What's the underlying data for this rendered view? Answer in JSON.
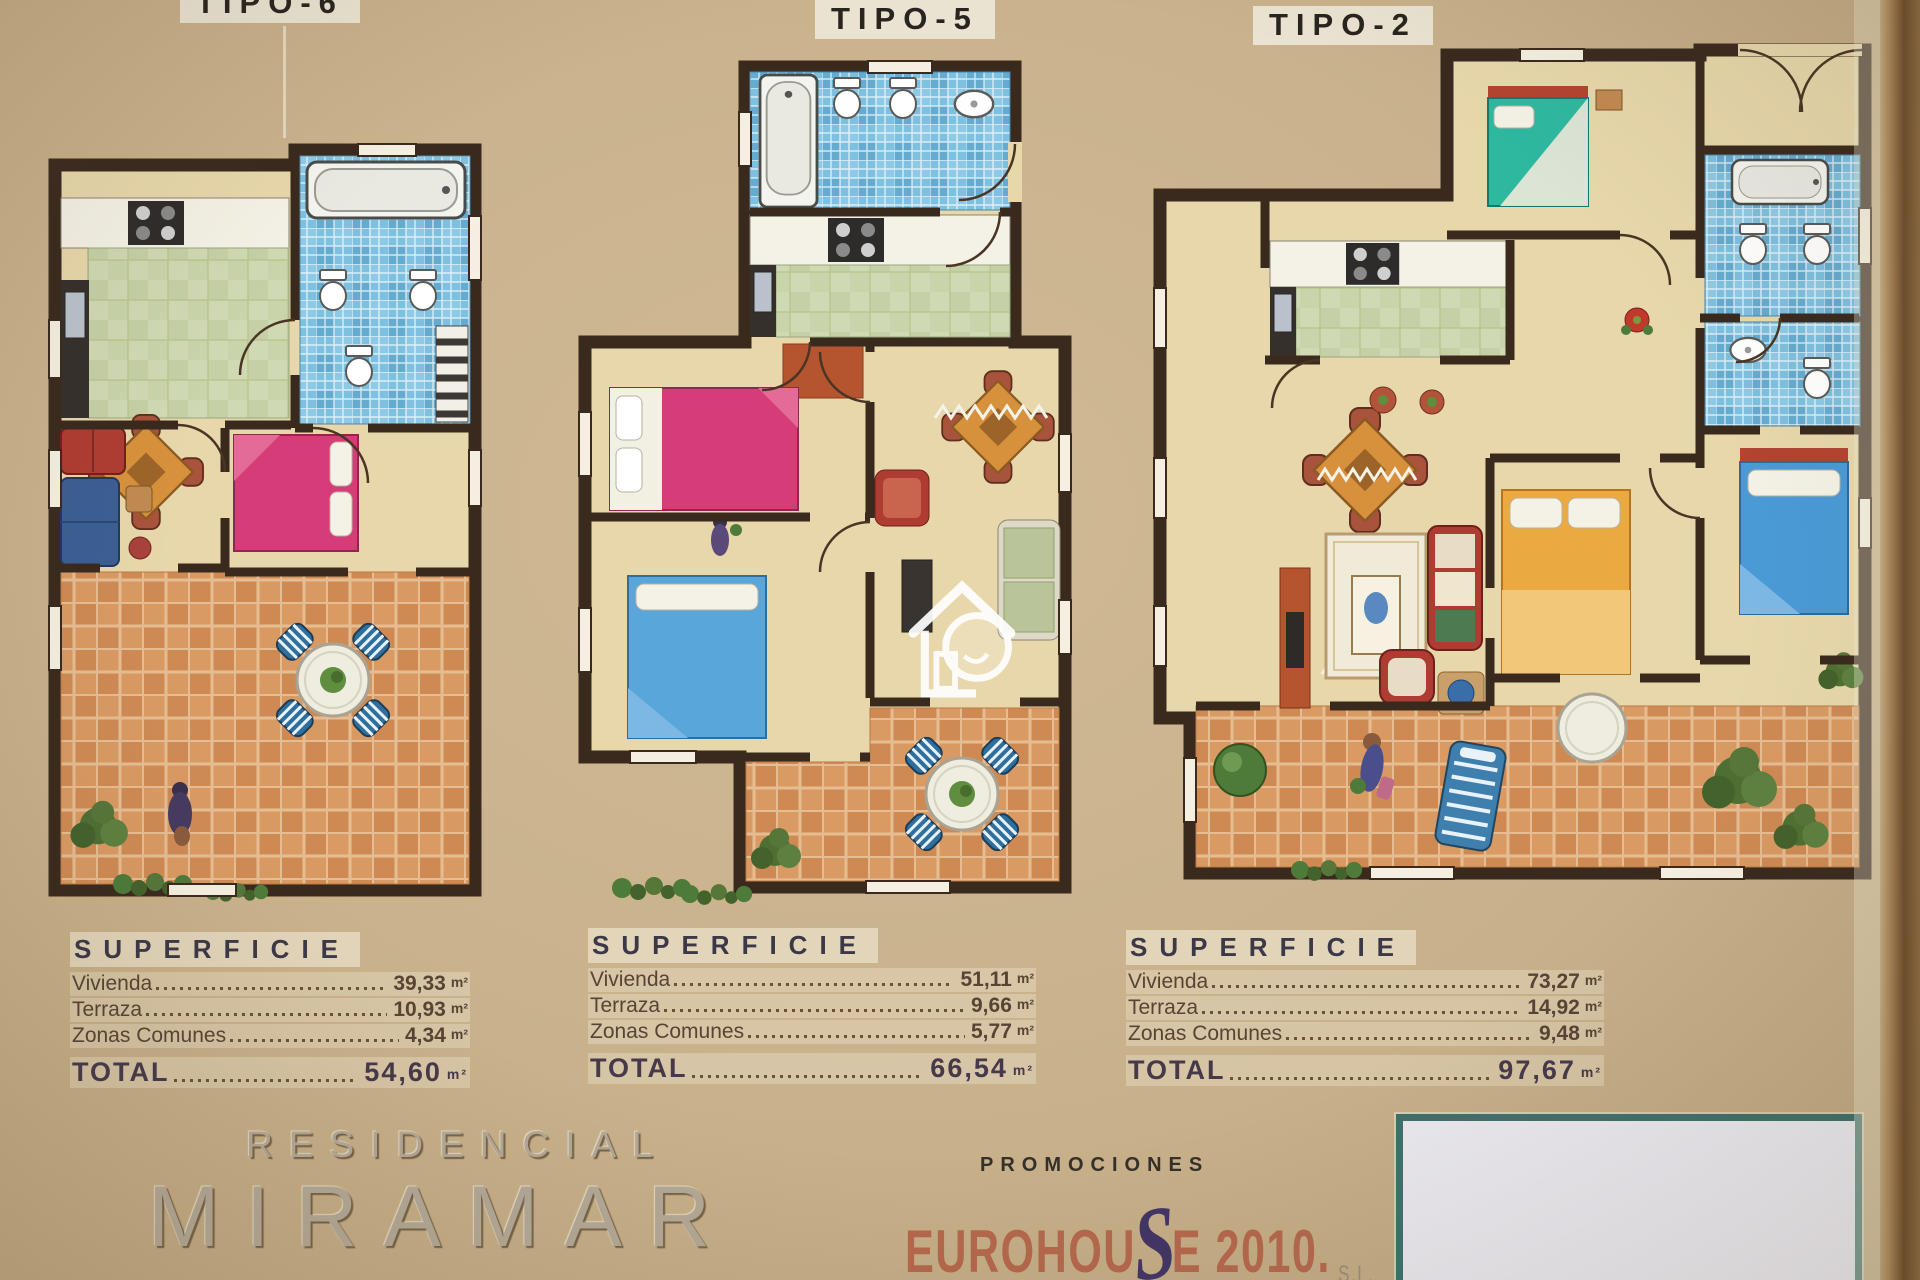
{
  "poster": {
    "plans": [
      {
        "title": "TIPO-6",
        "superficie": {
          "header": "SUPERFICIE",
          "unit": "m²",
          "rows": [
            {
              "label": "Vivienda",
              "value": "39,33"
            },
            {
              "label": "Terraza",
              "value": "10,93"
            },
            {
              "label": "Zonas Comunes",
              "value": "4,34"
            }
          ],
          "total_label": "TOTAL",
          "total_value": "54,60"
        }
      },
      {
        "title": "TIPO-5",
        "superficie": {
          "header": "SUPERFICIE",
          "unit": "m²",
          "rows": [
            {
              "label": "Vivienda",
              "value": "51,11"
            },
            {
              "label": "Terraza",
              "value": "9,66"
            },
            {
              "label": "Zonas Comunes",
              "value": "5,77"
            }
          ],
          "total_label": "TOTAL",
          "total_value": "66,54"
        }
      },
      {
        "title": "TIPO-2",
        "superficie": {
          "header": "SUPERFICIE",
          "unit": "m²",
          "rows": [
            {
              "label": "Vivienda",
              "value": "73,27"
            },
            {
              "label": "Terraza",
              "value": "14,92"
            },
            {
              "label": "Zonas Comunes",
              "value": "9,48"
            }
          ],
          "total_label": "TOTAL",
          "total_value": "97,67"
        }
      }
    ],
    "branding": {
      "residencial": "RESIDENCIAL",
      "name": "MIRAMAR",
      "promo_small": "PROMOCIONES",
      "brand_pre": "EUROHOU",
      "brand_s": "S",
      "brand_post": "E 2010.",
      "brand_suffix": "S.L."
    },
    "colors": {
      "background": "#c8b18b",
      "walls": "#3a2a1e",
      "floor": "#e7d7ab",
      "bath_tile": "#7dc0df",
      "kitchen_top": "#cfd9b3",
      "terrace_tile": "#cf8a54",
      "bed_pink": "#d63c78",
      "bed_blue": "#58a6da",
      "bed_teal": "#2eb8a0",
      "bed_orange": "#eba941",
      "sofa_red": "#af3c32",
      "table_orange": "#d7913c",
      "accent_navy": "#413566",
      "accent_terracotta": "#b5684e",
      "logo_box_border": "#3f706c"
    }
  }
}
